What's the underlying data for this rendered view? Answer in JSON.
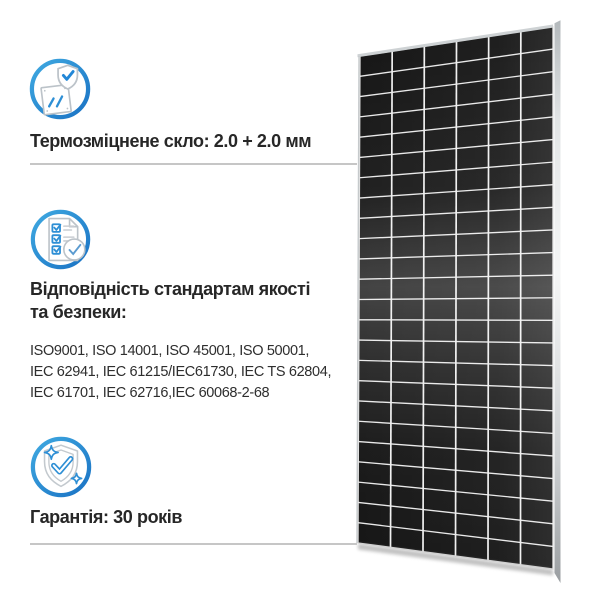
{
  "page": {
    "background_color": "#ffffff",
    "accent_blue": "#2287d7",
    "icon_outline_gray": "#bcc3c9",
    "text_color": "#272727",
    "divider_color": "#c6c6c6"
  },
  "features": [
    {
      "id": "tempered-glass",
      "icon": "glass-pane-shield-check-icon",
      "title_lines": [
        "Термозміцнене скло: 2.0 + 2.0 мм"
      ]
    },
    {
      "id": "standards-compliance",
      "icon": "checklist-check-icon",
      "title_lines": [
        "Відповідність стандартам якості",
        "та безпеки:"
      ],
      "body_lines": [
        "ISO9001, ISO 14001, ISO 45001, ISO 50001,",
        "IEC 62941, IEC 61215/IEC61730, IEC TS 62804,",
        "IEC 61701, IEC 62716,IEC 60068-2-68"
      ]
    },
    {
      "id": "warranty",
      "icon": "shield-sparkles-check-icon",
      "title_lines": [
        "Гарантія: 30 років"
      ]
    }
  ],
  "panel_image": {
    "description": "solar-panel-perspective-photo",
    "rows": 24,
    "columns": 6,
    "cell_color": "#151515",
    "grid_line_color": "#e9e9e9",
    "column_line_color": "#f0f0f0",
    "frame_color": "#ced2d4"
  }
}
